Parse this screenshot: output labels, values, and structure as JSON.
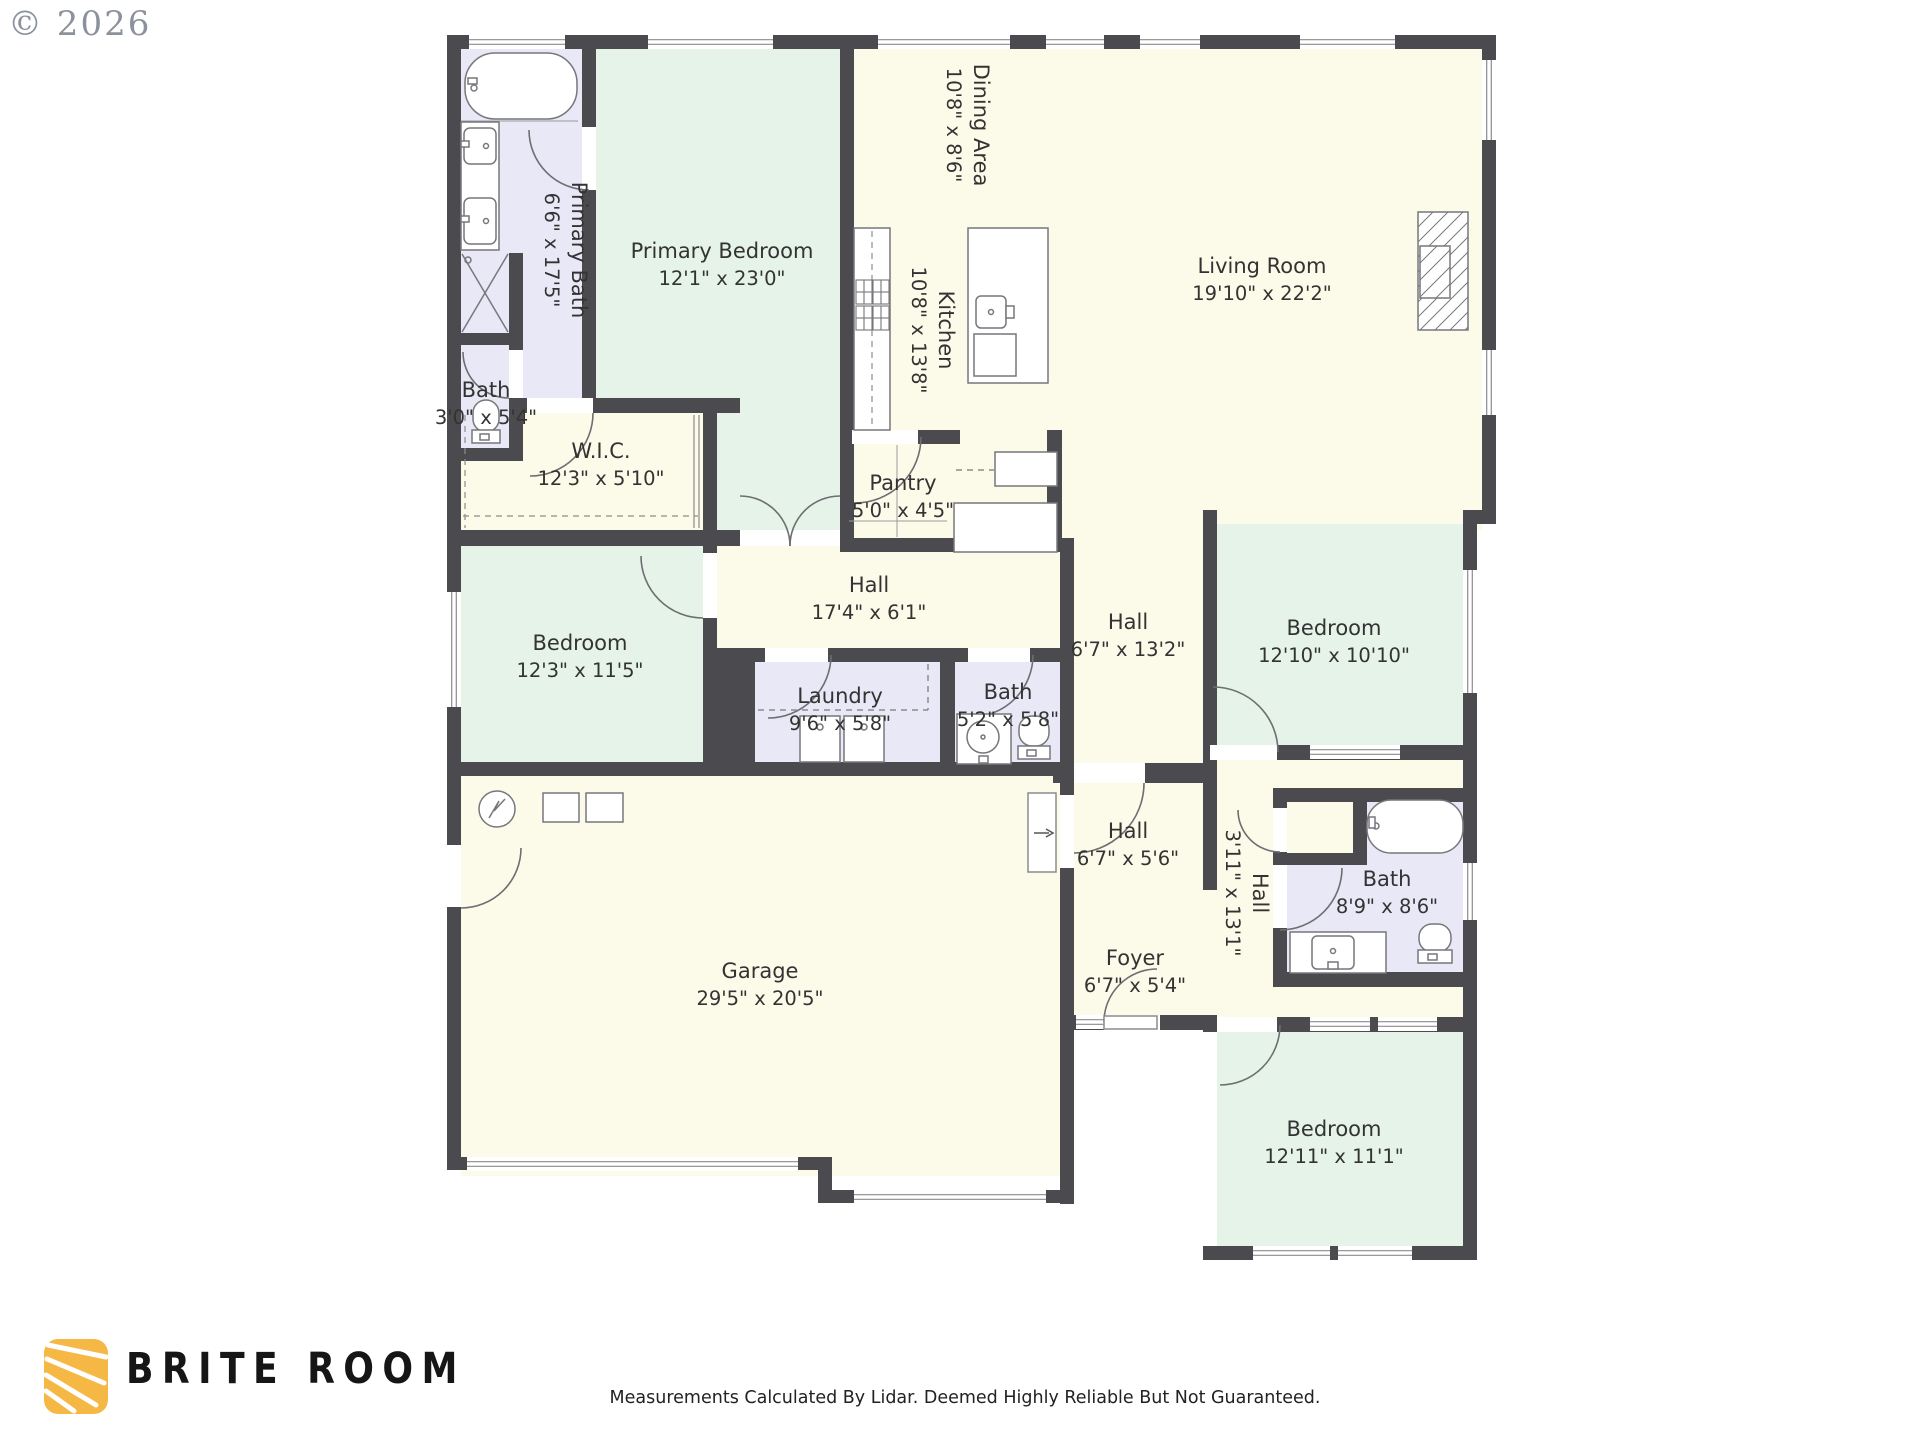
{
  "copyright": "© 2026",
  "footer": {
    "brand": "BRITE ROOM",
    "disclaimer": "Measurements Calculated By Lidar. Deemed Highly Reliable But Not Guaranteed.",
    "logo_icon": "sun-rays-icon"
  },
  "rooms": [
    {
      "id": "primary_bath",
      "name": "Primary Bath",
      "dims": "6'6\" x 17'5\""
    },
    {
      "id": "primary_bedroom",
      "name": "Primary Bedroom",
      "dims": "12'1\" x 23'0\""
    },
    {
      "id": "dining",
      "name": "Dining Area",
      "dims": "10'8\" x 8'6\""
    },
    {
      "id": "kitchen",
      "name": "Kitchen",
      "dims": "10'8\" x 13'8\""
    },
    {
      "id": "living",
      "name": "Living Room",
      "dims": "19'10\" x 22'2\""
    },
    {
      "id": "bath_small",
      "name": "Bath",
      "dims": "3'0\" x 5'4\""
    },
    {
      "id": "wic",
      "name": "W.I.C.",
      "dims": "12'3\" x 5'10\""
    },
    {
      "id": "pantry",
      "name": "Pantry",
      "dims": "5'0\" x 4'5\""
    },
    {
      "id": "hall17",
      "name": "Hall",
      "dims": "17'4\" x 6'1\""
    },
    {
      "id": "bedroom123",
      "name": "Bedroom",
      "dims": "12'3\" x 11'5\""
    },
    {
      "id": "laundry",
      "name": "Laundry",
      "dims": "9'6\" x 5'8\""
    },
    {
      "id": "bath52",
      "name": "Bath",
      "dims": "5'2\" x 5'8\""
    },
    {
      "id": "hall132",
      "name": "Hall",
      "dims": "6'7\" x 13'2\""
    },
    {
      "id": "bedroom1210",
      "name": "Bedroom",
      "dims": "12'10\" x 10'10\""
    },
    {
      "id": "hall311",
      "name": "Hall",
      "dims": "3'11\" x 13'1\""
    },
    {
      "id": "bath89",
      "name": "Bath",
      "dims": "8'9\" x 8'6\""
    },
    {
      "id": "garage",
      "name": "Garage",
      "dims": "29'5\" x 20'5\""
    },
    {
      "id": "hall56",
      "name": "Hall",
      "dims": "6'7\" x 5'6\""
    },
    {
      "id": "foyer",
      "name": "Foyer",
      "dims": "6'7\" x 5'4\""
    },
    {
      "id": "bedroom1211",
      "name": "Bedroom",
      "dims": "12'11\" x 11'1\""
    }
  ],
  "colors": {
    "wall": "#4b4b4f",
    "floor_common": "#fcfae9",
    "floor_bedroom": "#e5f3e8",
    "floor_bath": "#e8e8f6",
    "fixture_line": "#77777c",
    "window_line": "#8c8c8c",
    "label_text": "#333333",
    "logo_yellow": "#f6b845"
  }
}
